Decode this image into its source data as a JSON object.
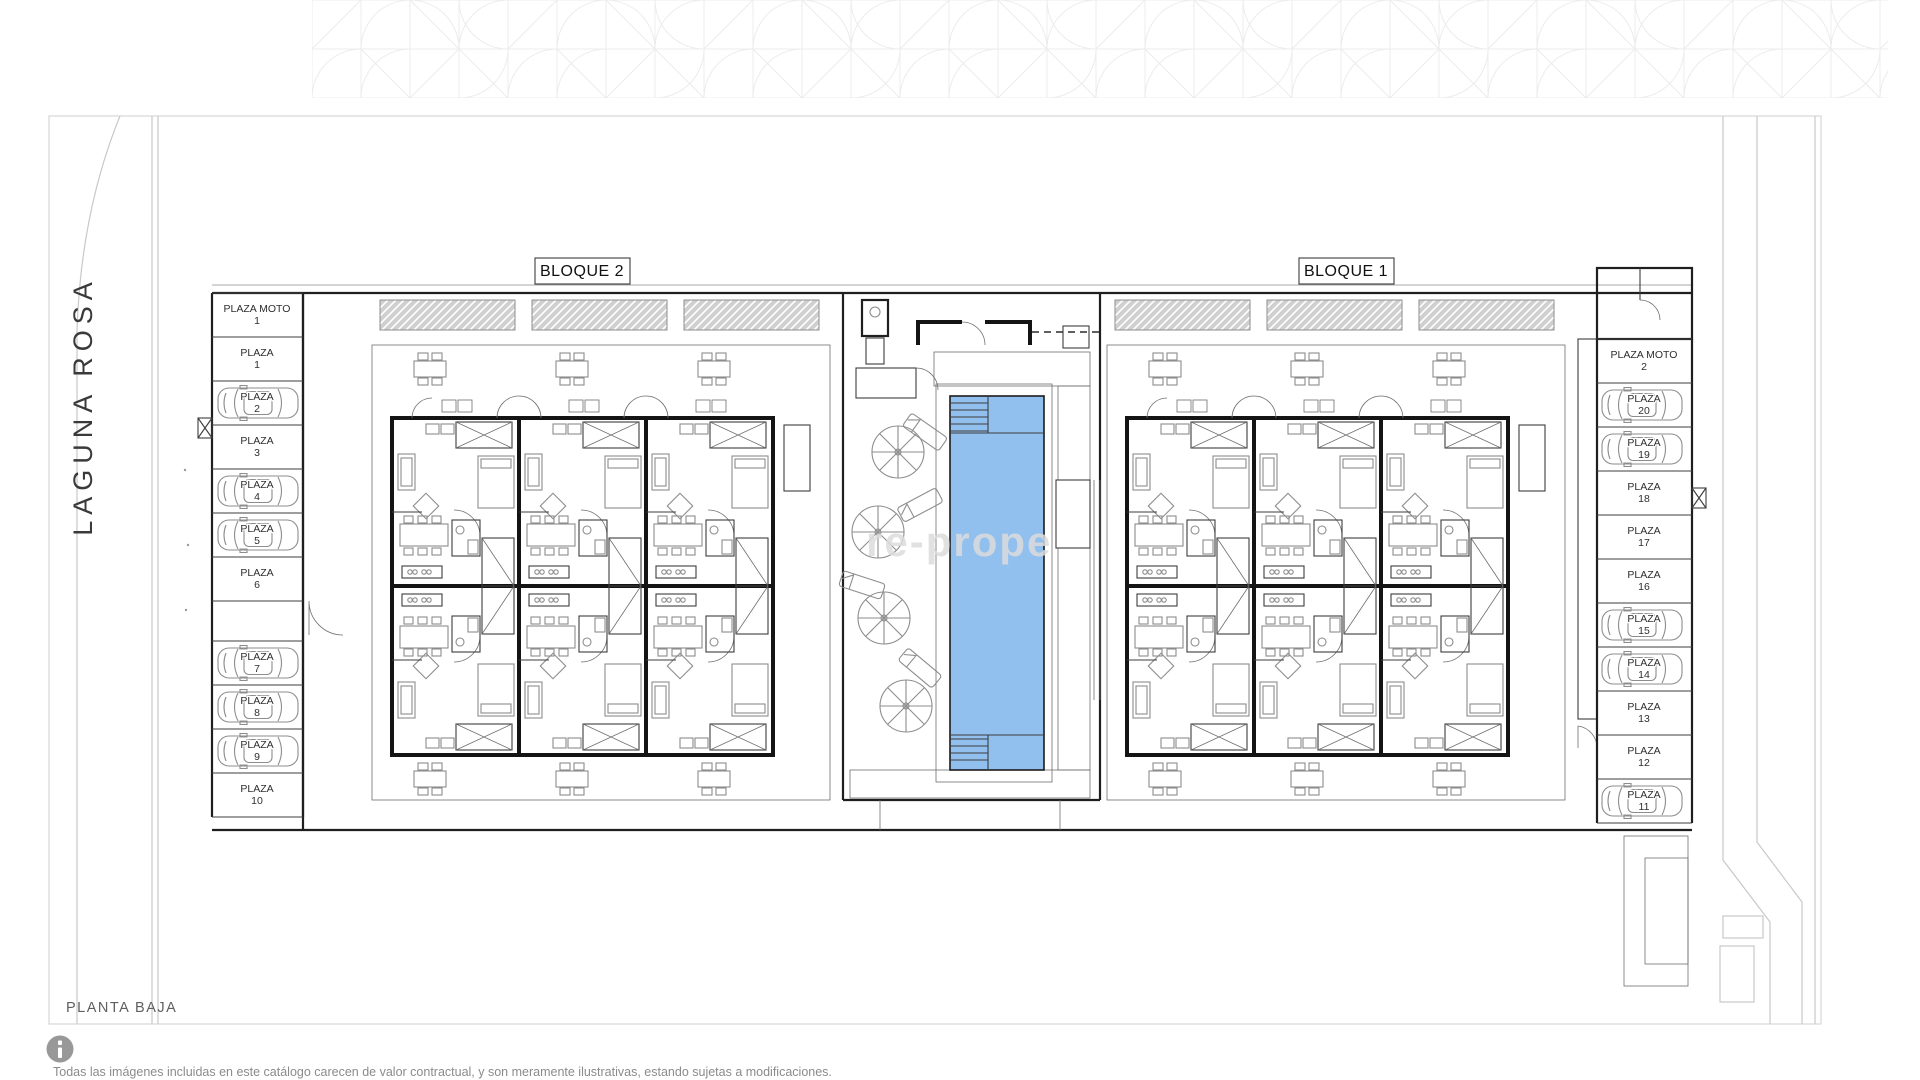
{
  "page": {
    "plan_level_label": "PLANTA BAJA",
    "street_name": "LAGUNA ROSA",
    "watermark": "re-prope",
    "disclaimer": "Todas las imágenes incluidas en este catálogo carecen de valor contractual, y son meramente ilustrativas, estando sujetas a modificaciones.",
    "icons": {
      "info": "info-icon"
    }
  },
  "blocks": [
    {
      "label": "BLOQUE 2"
    },
    {
      "label": "BLOQUE 1"
    }
  ],
  "pool": {
    "feature": "communal pool"
  },
  "colors": {
    "pool_water": "#92C0EE",
    "deck_speckle": "#b3c292",
    "pergola_gray": "#d0d0d0",
    "wall_black": "#141414"
  },
  "parking": {
    "left": [
      {
        "label": "PLAZA MOTO",
        "number": "1",
        "car": false
      },
      {
        "label": "PLAZA",
        "number": "1",
        "car": false
      },
      {
        "label": "PLAZA",
        "number": "2",
        "car": true
      },
      {
        "label": "PLAZA",
        "number": "3",
        "car": false
      },
      {
        "label": "PLAZA",
        "number": "4",
        "car": true
      },
      {
        "label": "PLAZA",
        "number": "5",
        "car": true
      },
      {
        "label": "PLAZA",
        "number": "6",
        "car": false
      },
      {
        "label": "PLAZA",
        "number": "7",
        "car": true
      },
      {
        "label": "PLAZA",
        "number": "8",
        "car": true
      },
      {
        "label": "PLAZA",
        "number": "9",
        "car": true
      },
      {
        "label": "PLAZA",
        "number": "10",
        "car": false
      }
    ],
    "right": [
      {
        "label": "PLAZA MOTO",
        "number": "2",
        "car": false
      },
      {
        "label": "PLAZA",
        "number": "20",
        "car": true
      },
      {
        "label": "PLAZA",
        "number": "19",
        "car": true
      },
      {
        "label": "PLAZA",
        "number": "18",
        "car": false
      },
      {
        "label": "PLAZA",
        "number": "17",
        "car": false
      },
      {
        "label": "PLAZA",
        "number": "16",
        "car": false
      },
      {
        "label": "PLAZA",
        "number": "15",
        "car": true
      },
      {
        "label": "PLAZA",
        "number": "14",
        "car": true
      },
      {
        "label": "PLAZA",
        "number": "13",
        "car": false
      },
      {
        "label": "PLAZA",
        "number": "12",
        "car": false
      },
      {
        "label": "PLAZA",
        "number": "11",
        "car": true
      }
    ]
  }
}
